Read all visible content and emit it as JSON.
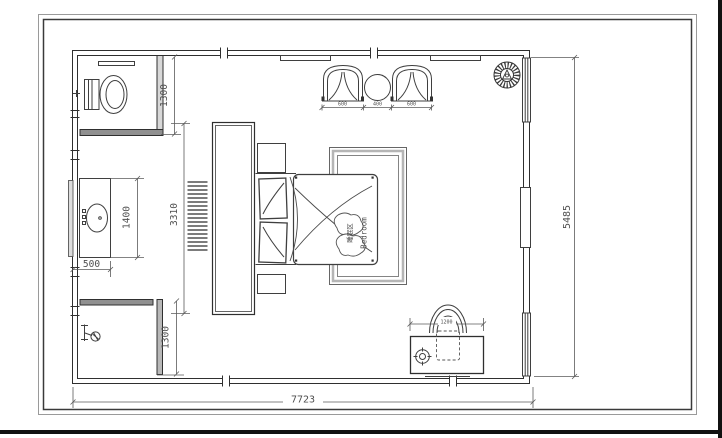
{
  "drawing_type": "bedroom-floor-plan",
  "plan": {
    "labels": {
      "bedroom_zh": "睡眠区",
      "bedroom_en": "Bedroom"
    },
    "dims": {
      "total_width": "7723",
      "total_depth": "5485",
      "wc_width": "1300",
      "vanity_length": "1400",
      "vanity_depth": "500",
      "headboard_length": "3310",
      "shower_width": "1300",
      "seat_left": "600",
      "seat_gap": "400",
      "seat_right": "600",
      "desk_length": "1200"
    },
    "colors": {
      "wall_line": "#2f2f2f",
      "dim_line": "#5a5a5a",
      "wall_fill": "#9a9a9a",
      "canvas_edge": "#111111",
      "rug_band": "#b5b5b5"
    }
  }
}
